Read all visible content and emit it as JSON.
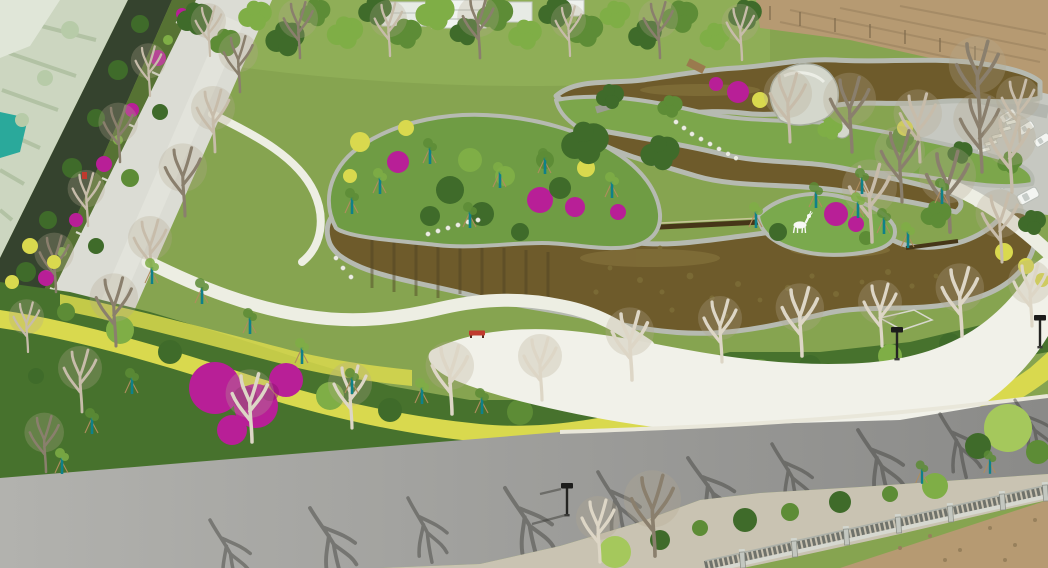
{
  "scene": {
    "title": "Aerial drone view of a newly landscaped park with winding brown ponds, white paths, flowering shrubs and a perimeter road",
    "time_of_day": "sunny daytime",
    "elements": {
      "farmland": "crop fields at upper left",
      "terraced_planters": "stepped planter beds with magenta flowers along boundary wall",
      "west_road": "light concrete road running diagonally on the left",
      "pond": "irregular brown ornamental pond with stone rip-rap edges and weirs",
      "garden_peninsula": "central garden mound with azaleas and clipped shrubs",
      "deer_sculpture": "white deer statue on pond peninsula",
      "plaza": "large white paved plaza south-east of the pond",
      "stepping_stones": "stepping-stone crossings over pond arms",
      "shrub_belt": "diagonal bands of yellow and green hedges with magenta bougainvillea",
      "south_road": "grey asphalt road across the bottom with tree shadows",
      "fence": "concrete-post mesh fence along lower right road edge",
      "dirt_field": "bare brown field at upper right",
      "parking": "white cars parked beyond trees on the right",
      "buildings": "white buildings behind the tree line at the top",
      "street_lamps": "dark square-head street lamps",
      "bench": "red park bench on white path",
      "saplings": "young staked trees with teal trunk wraps"
    }
  },
  "colors": {
    "grassBase": "#86a450",
    "grassLight": "#97b75d",
    "farm": "#ccd6c0",
    "farmRow": "#b2c2a4",
    "netTeal": "#2aa99b",
    "hedgeWall": "#35432e",
    "planter": "#567233",
    "road": "#dbdcd4",
    "asphaltL": "#b2b2ae",
    "asphaltD": "#8a8a88",
    "vergeGravel": "#c9c3b2",
    "plaza": "#f1f1e9",
    "path": "#edeee3",
    "water": "#6e5b2b",
    "waterDeep": "#4e4223",
    "stone": "#b6bab1",
    "leafDark": "#3f6b2a",
    "leafMid": "#5d8c36",
    "leafLight": "#7fae46",
    "leafBright": "#a5c85c",
    "yellow": "#d9d94e",
    "magenta": "#b81f97",
    "magentaDark": "#8e1172",
    "bare": "#c7bcaa",
    "bareDark": "#8a7f6d",
    "bareWhite": "#ddd6c6",
    "haze": "#b5a88f",
    "teal": "#0f8189",
    "stake": "#b08d5d",
    "dirt": "#b69a72",
    "dirtDark": "#97805c",
    "shadow": "#3c3c38",
    "white": "#f7f8f4",
    "lampDark": "#242422",
    "red": "#c03a2e",
    "carBody": "#f3f5f2",
    "fencePost": "#c3c7c0",
    "fenceMesh": "#5f645e",
    "building": "#e7ebe5",
    "rock": "#d4d7cc"
  }
}
